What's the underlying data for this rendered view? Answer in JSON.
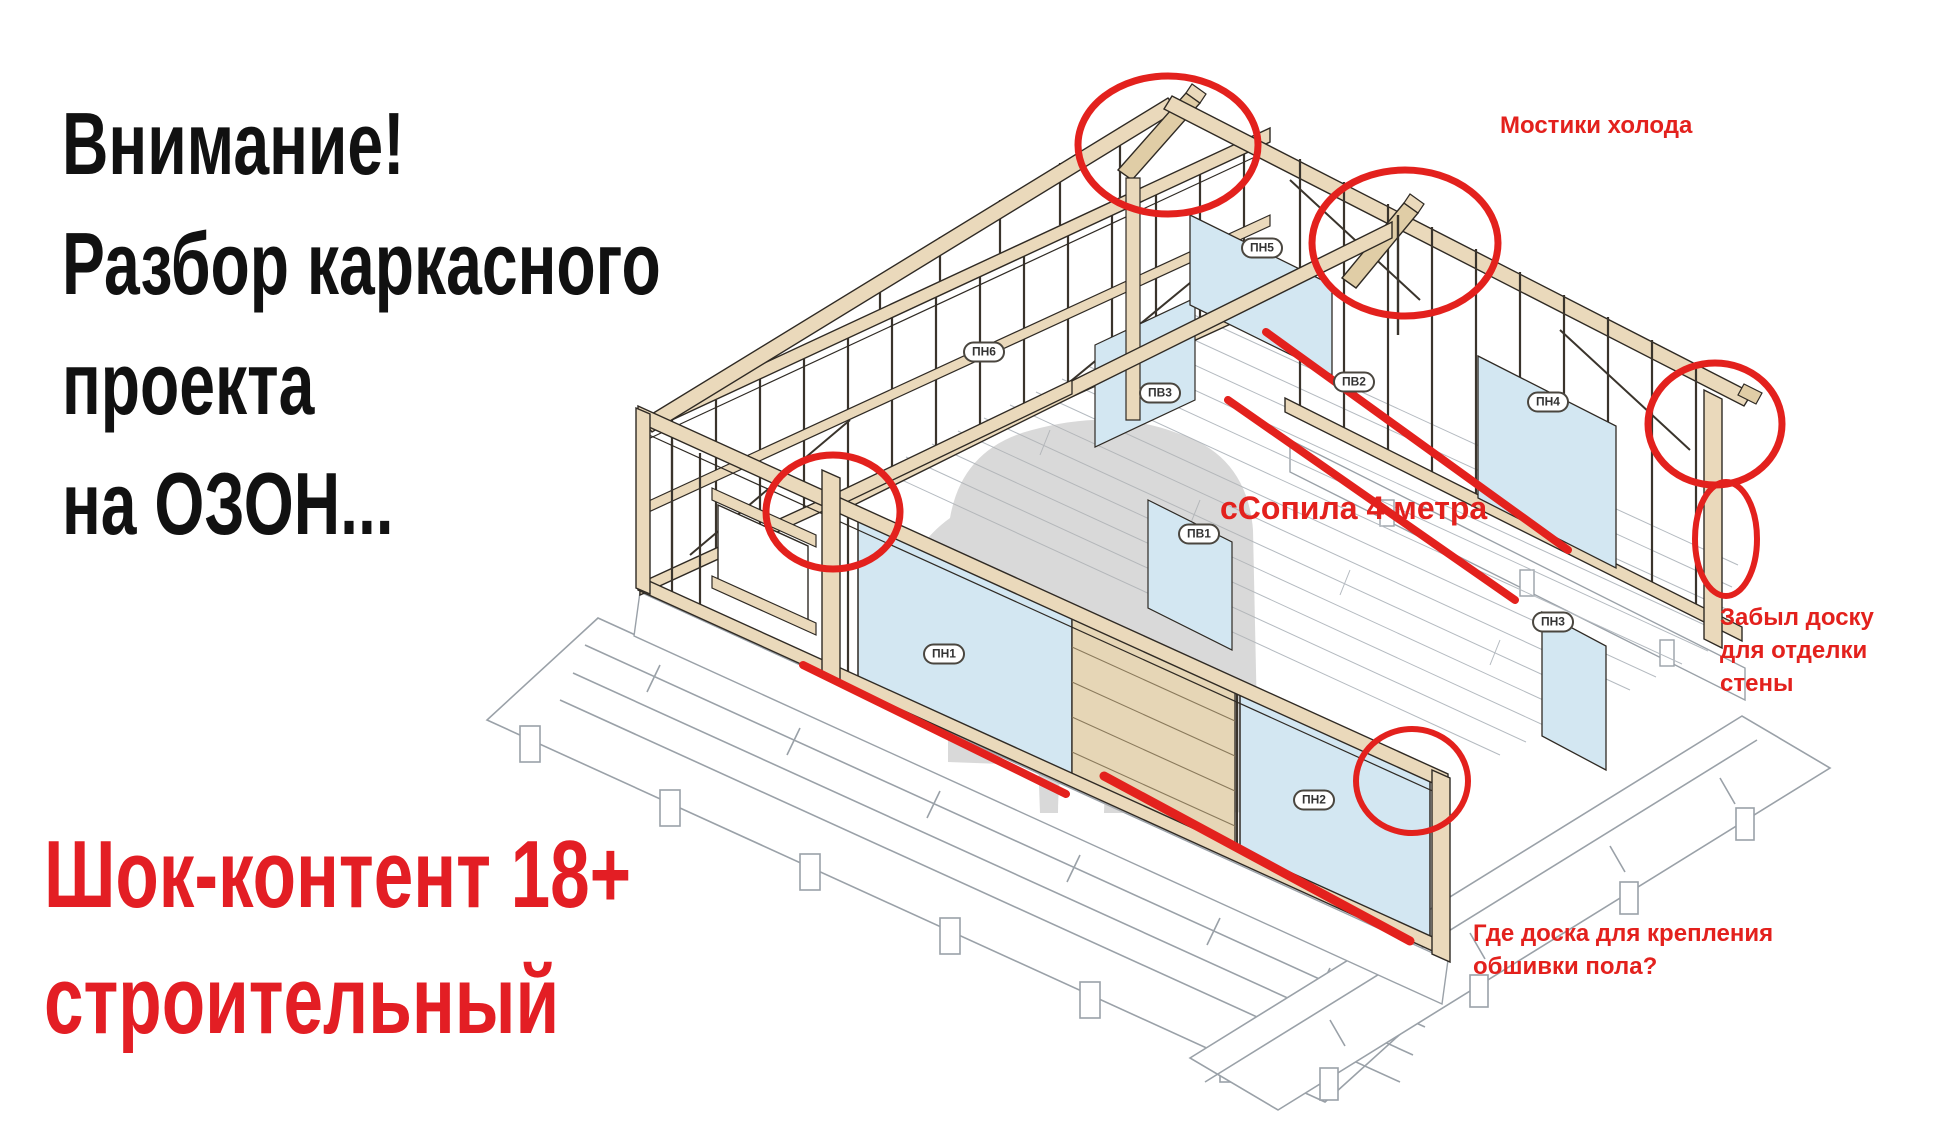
{
  "headline": {
    "color": "#111111",
    "lines": [
      "Внимание!",
      "Разбор каркасного",
      "проекта",
      "на ОЗОН..."
    ]
  },
  "shock_banner": {
    "color": "#e31e24",
    "lines": [
      "Шок-контент 18+",
      "строительный"
    ]
  },
  "diagram": {
    "frame_labels": [
      {
        "text": "ПН5"
      },
      {
        "text": "ПН6"
      },
      {
        "text": "ПВ3"
      },
      {
        "text": "ПВ2"
      },
      {
        "text": "ПН4"
      },
      {
        "text": "ПВ1"
      },
      {
        "text": "ПН1"
      },
      {
        "text": "ПН3"
      },
      {
        "text": "ПН2"
      }
    ],
    "annotations": {
      "cold_bridges": "Мостики холода",
      "rafter_note": "сСопила 4 метра",
      "missing_wall_board_lines": [
        "Забыл доску",
        "для отделки",
        "стены"
      ],
      "floor_sheathing_lines": [
        "Где доска для крепления",
        "обшивки пола?"
      ]
    },
    "colors": {
      "annotation_red": "#e3211d",
      "wood_fill": "#ead9bb",
      "wood_shade": "#e0cda6",
      "outline": "#2f2a24",
      "panel_blue": "#d3e7f2",
      "watermark_gray": "#b3b3b3"
    }
  }
}
